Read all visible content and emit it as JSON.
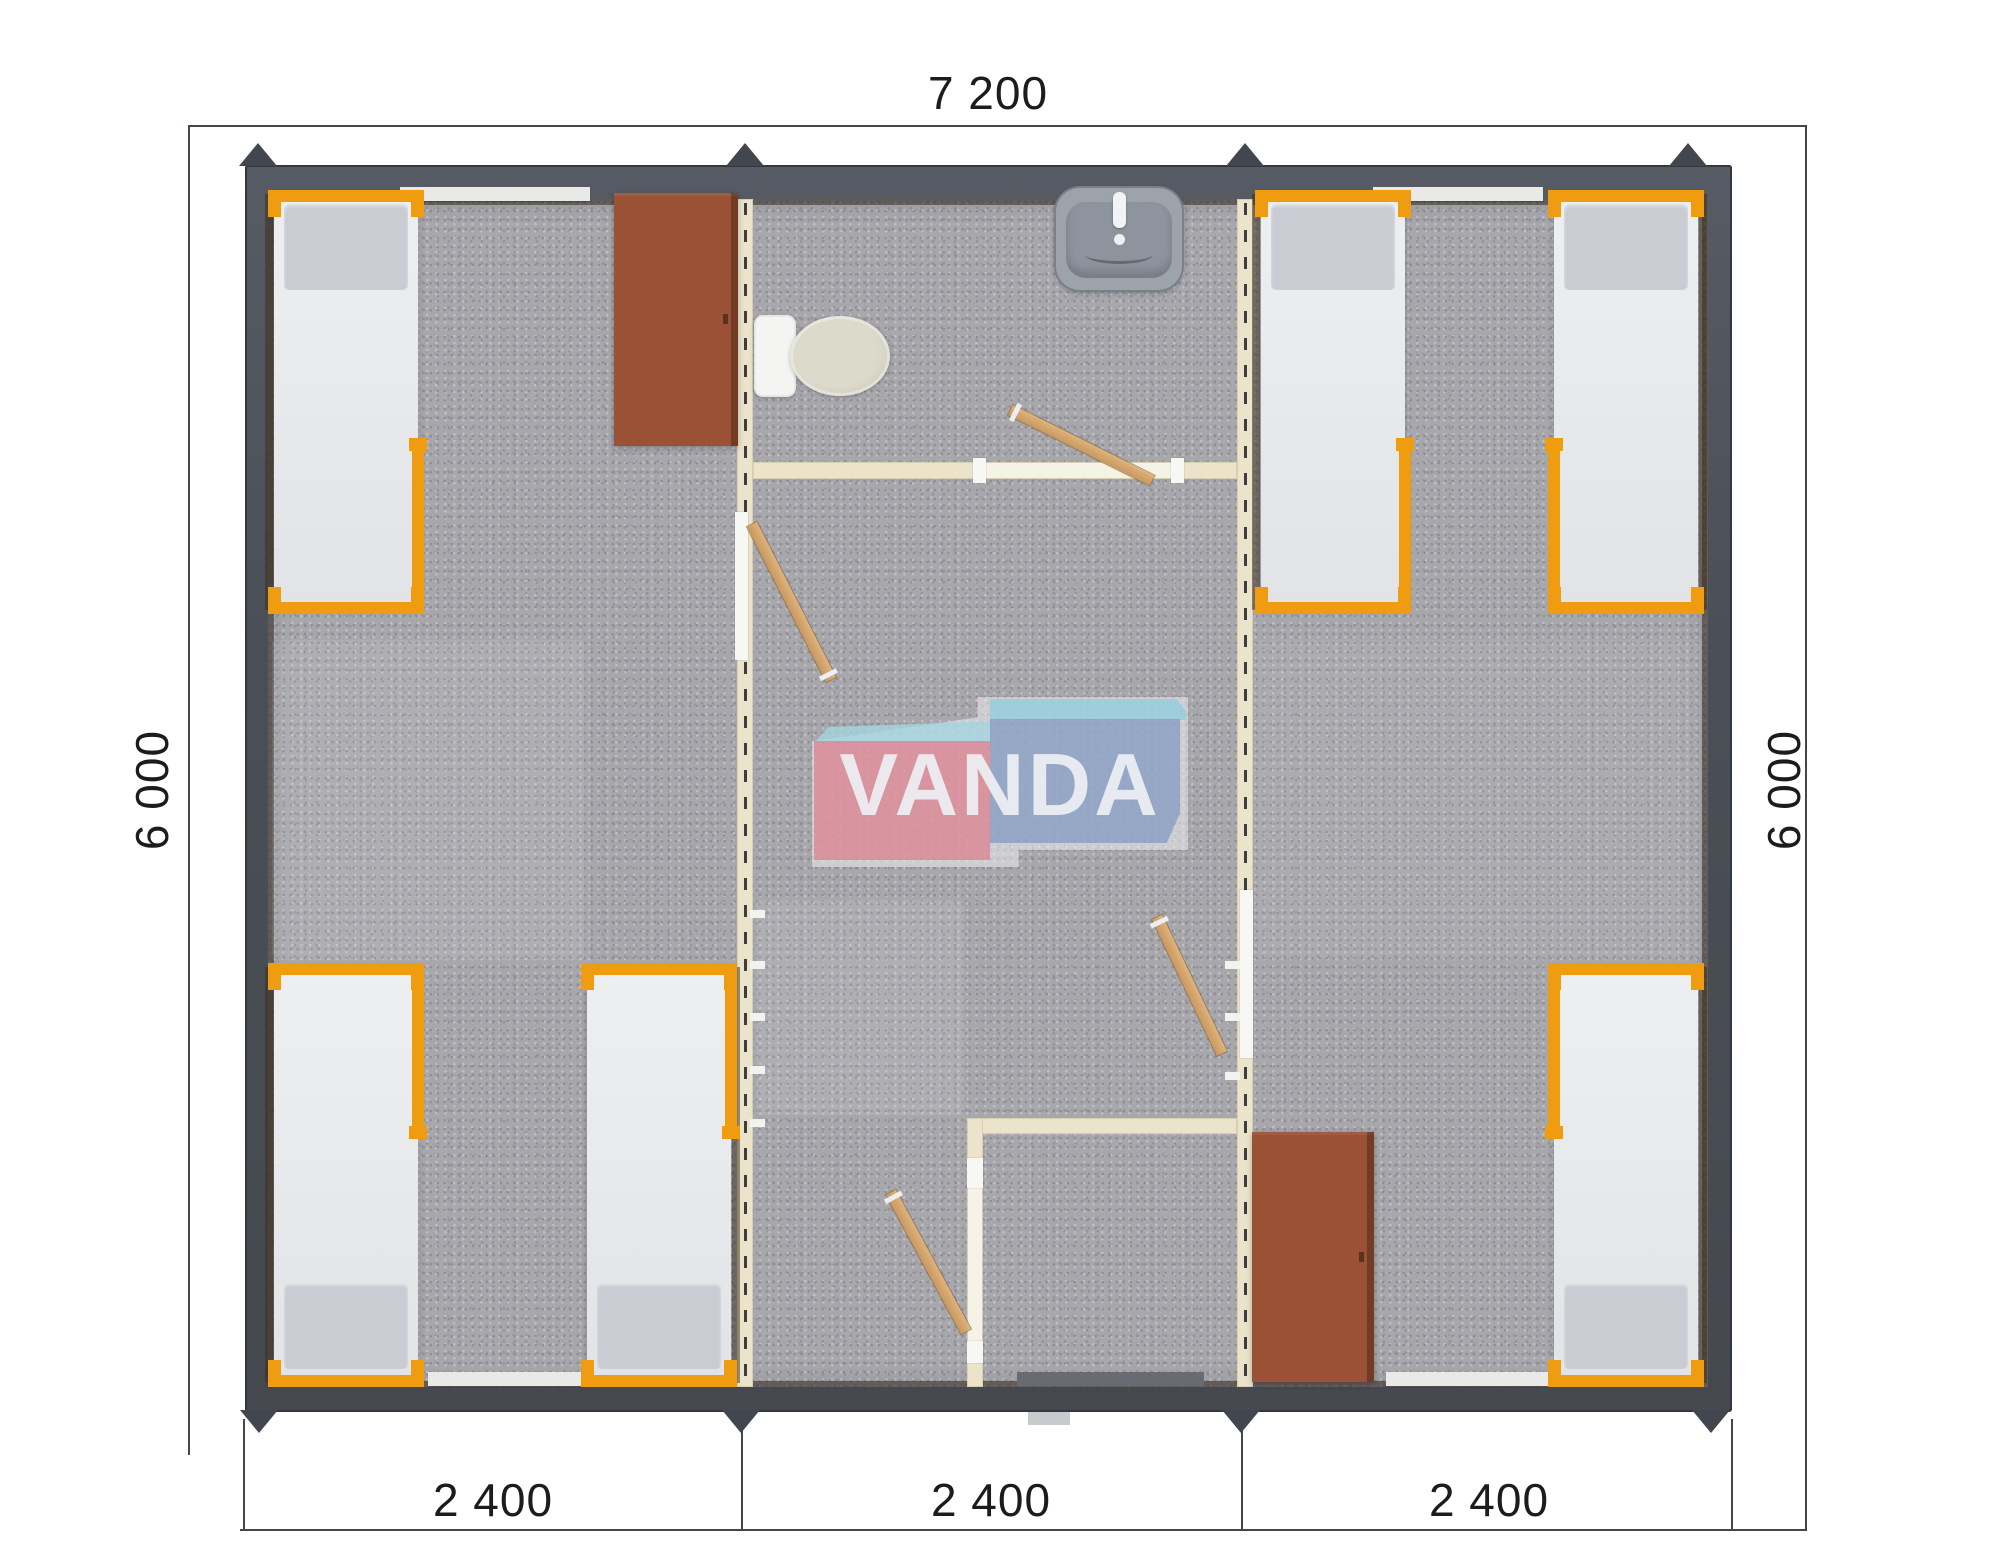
{
  "page": {
    "background": "#ffffff",
    "content": "modular building floor plan render"
  },
  "dimensions": {
    "top_width": "7 200",
    "left_height": "6 000",
    "right_height": "6 000",
    "bottom_segments": [
      "2 400",
      "2 400",
      "2 400"
    ]
  },
  "watermark": {
    "text": "VANDA",
    "pink_box_color": "#dc808d",
    "blue_box_color": "#859dc3",
    "cyan_top_color": "#92cedd"
  },
  "palette": {
    "exterior_wall": "#4a4e56",
    "floor": "#a7a7ac",
    "partition_wall": "#ebe3ca",
    "bed_frame_orange": "#ef9c10",
    "mattress": "#e9ebee",
    "wardrobe_brown": "#9a5136",
    "door_wood": "#d2a468",
    "dimension_ink": "#1c1c1c"
  }
}
